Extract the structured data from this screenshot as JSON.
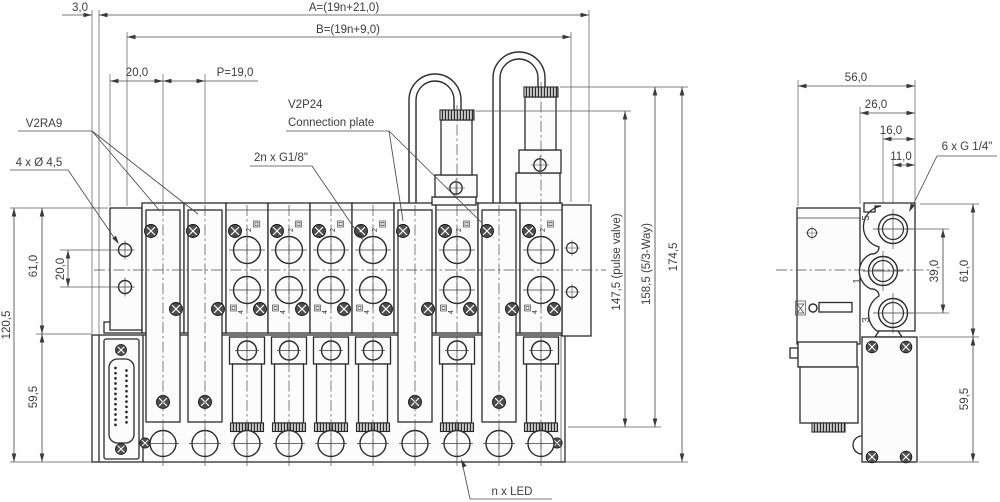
{
  "front_view": {
    "dims_top": {
      "offset_3": "3,0",
      "overall_a": "A=(19n+21,0)",
      "overall_b": "B=(19n+9,0)",
      "edge_20": "20,0",
      "pitch": "P=19,0"
    },
    "dims_left": {
      "height_upper": "61,0",
      "hole_spacing": "20,0",
      "height_total": "120,5",
      "height_lower": "59,5"
    },
    "dims_right": {
      "pulse_valve": "147,5 (pulse valve)",
      "five_three_way": "158,5 (5/3-Way)",
      "overall": "174,5"
    },
    "labels": {
      "blanking_plate": "V2RA9",
      "mounting_holes": "4 x Ø 4,5",
      "connection_plate_1": "V2P24",
      "connection_plate_2": "Connection plate",
      "working_ports": "2n x G1/8\"",
      "led": "n x LED"
    },
    "valve_markings": {
      "port_2": "2",
      "port_4": "4"
    }
  },
  "side_view": {
    "dims_top": {
      "depth": "56,0",
      "dim_26": "26,0",
      "dim_16": "16,0",
      "dim_11": "11,0"
    },
    "dims_right": {
      "port_spacing": "39,0",
      "height_upper": "61,0",
      "height_lower": "59,5"
    },
    "labels": {
      "ports": "6 x G 1/4\""
    },
    "port_numbers": {
      "top": "5",
      "middle": "1",
      "bottom": "3"
    }
  }
}
